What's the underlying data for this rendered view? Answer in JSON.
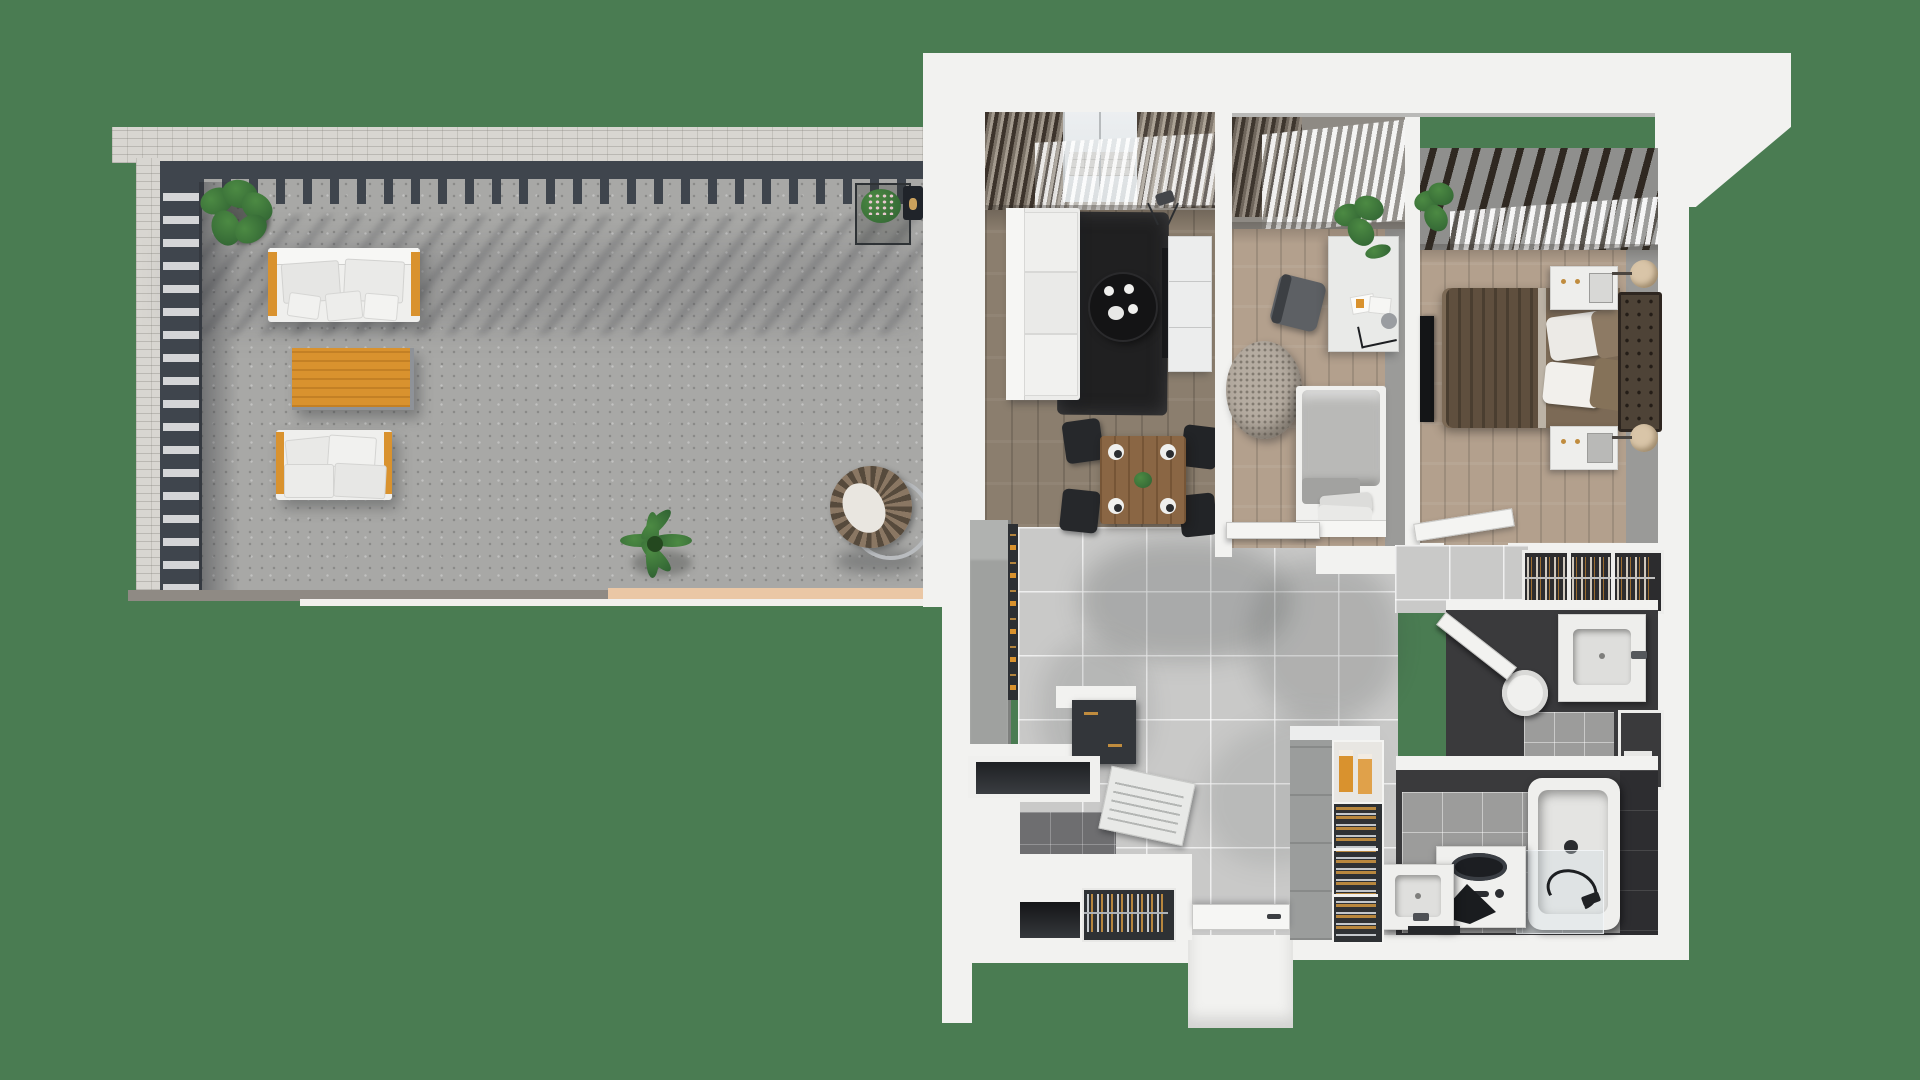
{
  "scene": {
    "description": "top-down 3D rendered floor plan of an apartment with a large wrap terrace",
    "view": "top-down isometric render",
    "background_color": "#4a7c52"
  },
  "palette": {
    "green": "#4a7c52",
    "wall": "#f2f2f0",
    "brick": "#d8d6d1",
    "slate": "#3f454d",
    "concrete": "#a8a8a6",
    "wood": "#8b7e6e",
    "woodlight": "#b3a08d",
    "tile": "#c9c9c8",
    "darkroom": "#3a3a3c",
    "charcoal": "#33363a",
    "orange": "#d9922e",
    "brass": "#c08c3e",
    "rug": "#202021",
    "bedbrown": "#7c6a56",
    "headboard": "#4e4337",
    "plant": "#2f6132",
    "plantlt": "#4c8a43",
    "graycab": "#9fa19f",
    "peach": "#eac7a5",
    "sheer": "#eff1f2"
  },
  "terrace": {
    "name": "terrace",
    "elements": [
      "brick-parapet-wall",
      "pergola-beams",
      "slat-railing",
      "concrete-floor",
      "corner-plant",
      "flower-planter",
      "wall-lantern",
      "outdoor-sofa-top",
      "outdoor-sofa-bottom",
      "orange-coffee-table",
      "palm-plant",
      "hanging-egg-chair",
      "deck-edge-strip"
    ]
  },
  "apartment": {
    "rooms": [
      {
        "name": "living-room",
        "floor": "dark-wood",
        "furniture": [
          "window-blinds",
          "white-sofa",
          "black-rug",
          "round-coffee-table",
          "tea-set",
          "tv-console",
          "tv-panel",
          "tripod-lamp",
          "dining-table",
          "dining-chairs",
          "plates"
        ]
      },
      {
        "name": "second-bedroom",
        "floor": "light-wood",
        "furniture": [
          "sheer-curtains",
          "desk",
          "desk-lamp",
          "office-chair",
          "monstera-plant",
          "marble-pouf",
          "single-bed",
          "open-door"
        ]
      },
      {
        "name": "master-bedroom",
        "floor": "light-wood",
        "furniture": [
          "beam-blinds",
          "sheer-curtain",
          "double-bed",
          "brown-throw",
          "pillows",
          "tufted-headboard",
          "nightstand",
          "wall-lamp",
          "tv-panel",
          "plant",
          "open-door"
        ]
      },
      {
        "name": "hallway",
        "floor": "large-tile",
        "furniture": [
          "entrance-door",
          "shadow-patches"
        ]
      },
      {
        "name": "dressing-closet",
        "furniture": [
          "hanger-rail-sections"
        ]
      },
      {
        "name": "kitchen",
        "furniture": [
          "tall-cabinet",
          "pantry-shelf",
          "white-counter",
          "dark-base-cabinets",
          "open-dishwasher",
          "knife-drawer",
          "counter-niche"
        ]
      },
      {
        "name": "pantry-wine-unit",
        "furniture": [
          "cereal-boxes",
          "wine-bottle-racks"
        ]
      },
      {
        "name": "wc",
        "furniture": [
          "wall-hung-vanity",
          "basin",
          "toilet",
          "open-door",
          "service-niche"
        ]
      },
      {
        "name": "bathroom",
        "furniture": [
          "vanity-sink",
          "bath-mat",
          "washing-machine",
          "bathtub",
          "shower-screen",
          "shower-hose"
        ]
      }
    ]
  }
}
